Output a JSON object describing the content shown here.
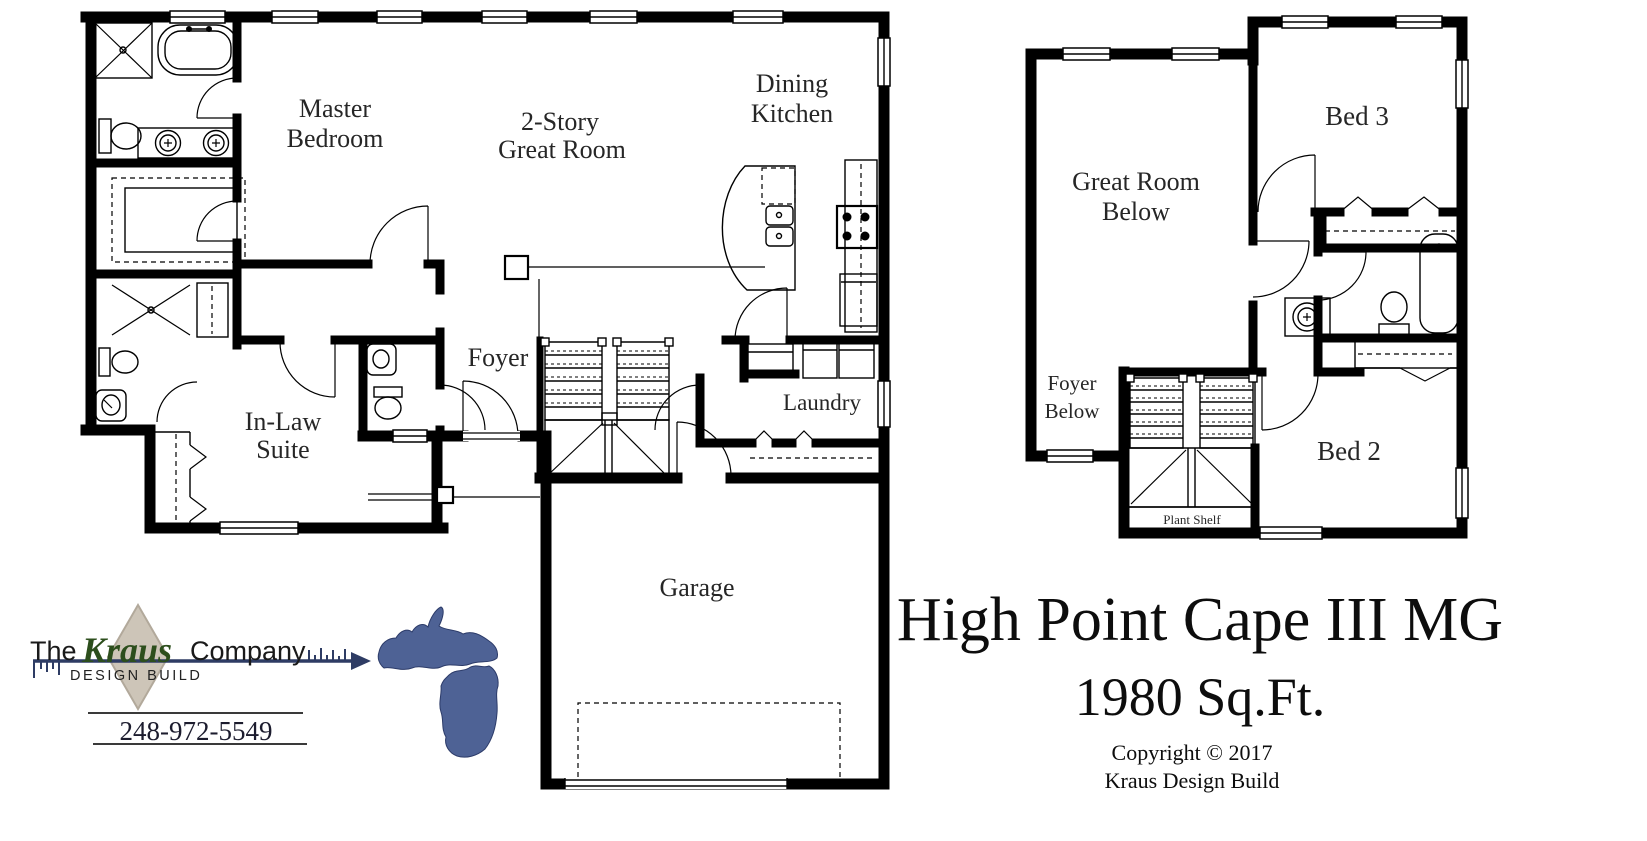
{
  "floors": {
    "first": {
      "rooms": {
        "master_bedroom": {
          "lines": [
            "Master",
            "Bedroom"
          ]
        },
        "great_room": {
          "lines": [
            "2-Story",
            "Great Room"
          ]
        },
        "dining_kitchen": {
          "lines": [
            "Dining",
            "Kitchen"
          ]
        },
        "foyer": {
          "label": "Foyer"
        },
        "in_law_suite": {
          "lines": [
            "In-Law",
            "Suite"
          ]
        },
        "laundry": {
          "label": "Laundry"
        },
        "garage": {
          "label": "Garage"
        }
      }
    },
    "second": {
      "rooms": {
        "great_room_below": {
          "lines": [
            "Great Room",
            "Below"
          ]
        },
        "bed_3": {
          "label": "Bed 3"
        },
        "foyer_below": {
          "lines": [
            "Foyer",
            "Below"
          ]
        },
        "bed_2": {
          "label": "Bed 2"
        },
        "plant_shelf": {
          "label": "Plant Shelf"
        }
      }
    }
  },
  "branding": {
    "logo": {
      "prefix": "The",
      "name": "Kraus",
      "suffix": "Company",
      "tagline": "DESIGN BUILD"
    },
    "phone": "248-972-5549",
    "colors": {
      "kraus_green": "#2c4e1c",
      "arrow_navy": "#2e3c64",
      "diamond_tan": "#cdc5b8",
      "michigan_blue": "#4e6295"
    }
  },
  "title_block": {
    "plan_name": "High Point Cape III MG",
    "area": "1980 Sq.Ft.",
    "copyright_line1": "Copyright © 2017",
    "copyright_line2": "Kraus Design Build"
  }
}
